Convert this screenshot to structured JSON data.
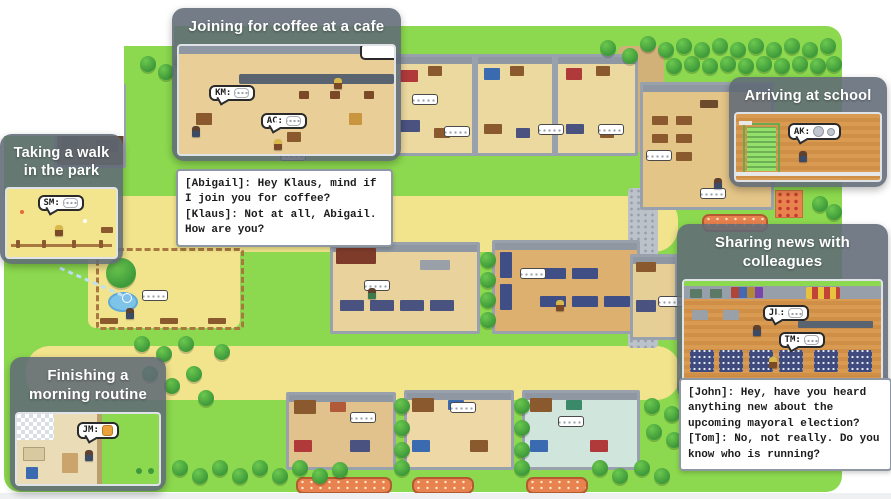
{
  "callouts": [
    {
      "id": "coffee",
      "title": "Joining for coffee at a cafe",
      "bubbles": [
        {
          "label": "KM:",
          "icon": "chat-dots-icon"
        },
        {
          "label": "AC:",
          "icon": "chat-dots-icon"
        }
      ],
      "dialogue": [
        "[Abigail]: Hey Klaus, mind if",
        "I join you for coffee?",
        "[Klaus]: Not at all, Abigail.",
        "How are you?"
      ]
    },
    {
      "id": "walk",
      "title": "Taking a walk in the park",
      "bubbles": [
        {
          "label": "SM:",
          "icon": "chat-dots-icon"
        }
      ]
    },
    {
      "id": "school",
      "title": "Arriving at school",
      "bubbles": [
        {
          "label": "AK:",
          "icon": "gray-circle-icon"
        }
      ]
    },
    {
      "id": "news",
      "title": "Sharing news with colleagues",
      "bubbles": [
        {
          "label": "JL:",
          "icon": "chat-dots-icon"
        },
        {
          "label": "TM:",
          "icon": "chat-dots-icon"
        }
      ],
      "dialogue": [
        "[John]: Hey, have you heard",
        "anything new about the",
        "upcoming mayoral election?",
        "[Tom]: No, not really. Do you",
        "know who is running?"
      ]
    },
    {
      "id": "routine",
      "title": "Finishing a morning routine",
      "bubbles": [
        {
          "label": "JM:",
          "icon": "orange-box-icon"
        }
      ]
    }
  ],
  "colors": {
    "grass": "#8cd94f",
    "path_yellow": "#f2e48c",
    "callout_frame": "#606a76",
    "dialogue_bg": "#ffffff",
    "sign_orange": "#e8824e",
    "pond_blue": "#7ec3e8",
    "wood_floor": "#d99a52",
    "wall_gray": "#8f97a2"
  }
}
